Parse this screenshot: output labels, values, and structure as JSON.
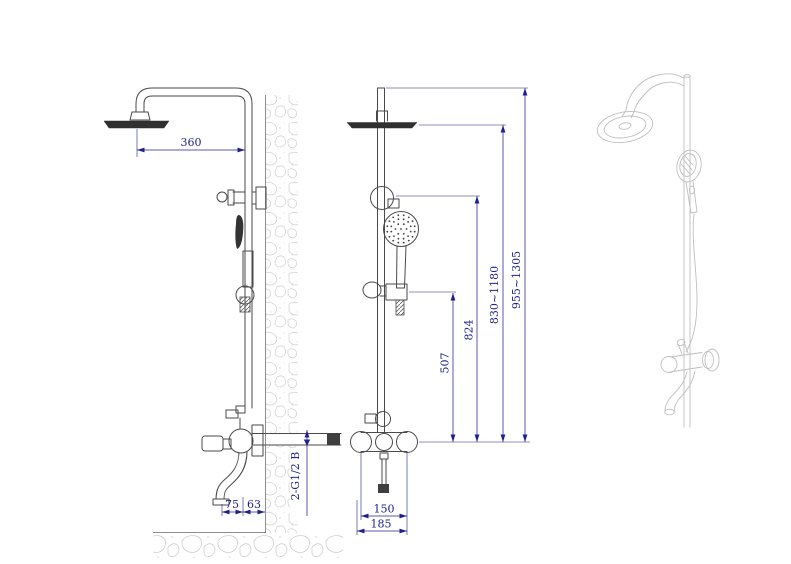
{
  "drawing": {
    "type": "technical-drawing",
    "subject": "shower column with rain head, hand shower and wall mixer - three views",
    "colors": {
      "background": "#ffffff",
      "outline": "#4a4a4a",
      "dark_fill": "#303030",
      "dimension": "#21218c",
      "light_gray": "#bfbfbf",
      "hatch_gray": "#d0d0d0",
      "wall_line": "#8f8f8f"
    },
    "dimensions": {
      "head_offset": "360",
      "spout_reach": "75",
      "spout_gap": "63",
      "inlet_thread": "2-G1/2 B",
      "slider_height": "507",
      "holder_height": "824",
      "head_height_range": "830~1180",
      "overall_height_range": "955~1305",
      "inlet_centers": "150",
      "valve_width": "185"
    }
  }
}
